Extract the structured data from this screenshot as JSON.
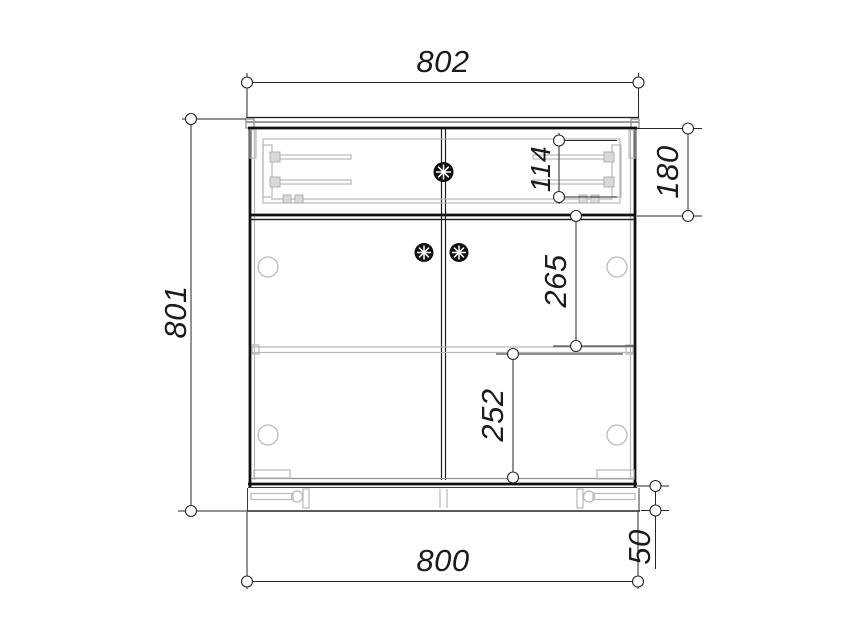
{
  "drawing": {
    "kind": "cabinet-front-elevation-technical-drawing",
    "dims": {
      "top_width": "802",
      "overall_height": "801",
      "drawer_rail_pitch": "114",
      "drawer_front_height": "180",
      "door_top_to_shelf": "265",
      "shelf_to_door_bottom": "252",
      "bottom_width": "800",
      "plinth_height": "50"
    },
    "colors": {
      "background": "#ffffff",
      "outline": "#1c1c1c",
      "hardware": "#b7b7b7",
      "dimension": "#262626"
    }
  }
}
